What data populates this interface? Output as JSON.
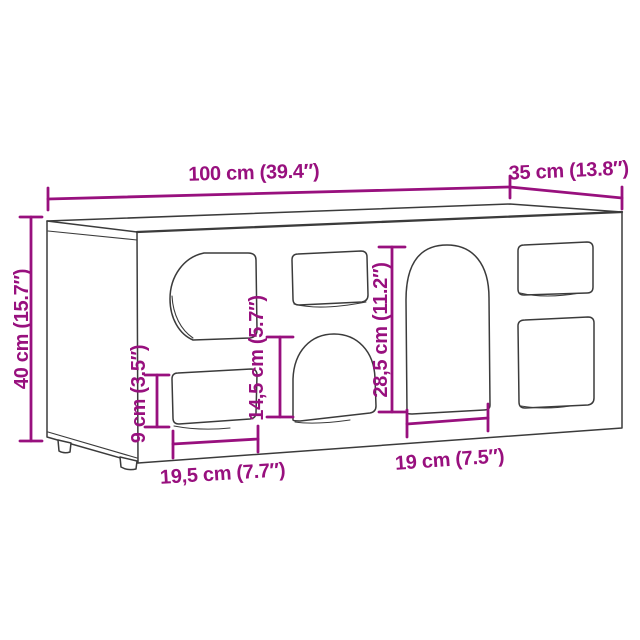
{
  "page": {
    "description": "Product dimension diagram of a sideboard cabinet with cut-out play openings",
    "background": "#ffffff"
  },
  "colors": {
    "accent": "#98107E",
    "line": "#3B3B3B"
  },
  "labels": {
    "width": "100 cm (39.4″)",
    "depth": "35 cm (13.8″)",
    "height": "40 cm (15.7″)",
    "left_cutout_height": "9 cm (3.5″)",
    "dome_cutout_height": "14,5 cm (5.7″)",
    "arch_cutout_height": "28,5 cm (11.2″)",
    "left_cutout_width": "19,5 cm (7.7″)",
    "arch_cutout_width": "19 cm (7.5″)"
  }
}
